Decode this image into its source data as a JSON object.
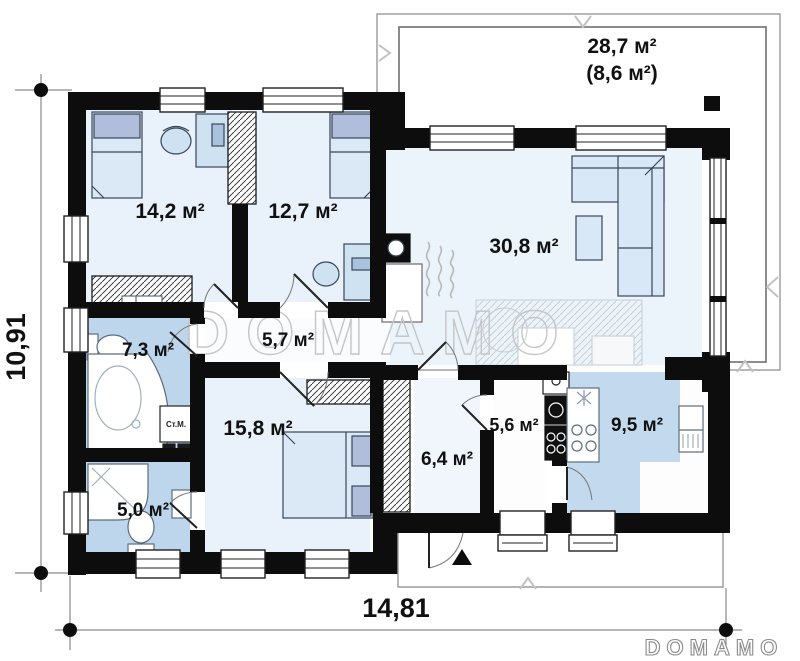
{
  "plan": {
    "rooms": {
      "bedroom1": {
        "area": "14,2 м²"
      },
      "bedroom2": {
        "area": "12,7 м²"
      },
      "living": {
        "area": "30,8 м²"
      },
      "terrace_total": {
        "area": "28,7 м²"
      },
      "terrace_part": {
        "area": "(8,6 м²)"
      },
      "bathroom": {
        "area": "7,3 м²"
      },
      "hall": {
        "area": "5,7 м²"
      },
      "bedroom3": {
        "area": "15,8 м²"
      },
      "wc": {
        "area": "5,0 м²"
      },
      "entry": {
        "area": "6,4 м²"
      },
      "pantry": {
        "area": "5,6 м²"
      },
      "kitchen": {
        "area": "9,5 м²"
      }
    },
    "dimensions": {
      "height": "10,91",
      "width": "14,81"
    },
    "labels": {
      "washing_machine": "Ст.М."
    },
    "watermark": {
      "center": "DOMAMO",
      "logo": "DOMAMO"
    },
    "colors": {
      "wall": "#0d0d0d",
      "floor_light": "#e9f1fa",
      "floor_blue": "#bdd6ec",
      "furniture": "#d7e7f6",
      "pillow": "#b0bedb",
      "watermark": "#c6c6c6",
      "dimension_line": "#8a8a8a"
    }
  }
}
